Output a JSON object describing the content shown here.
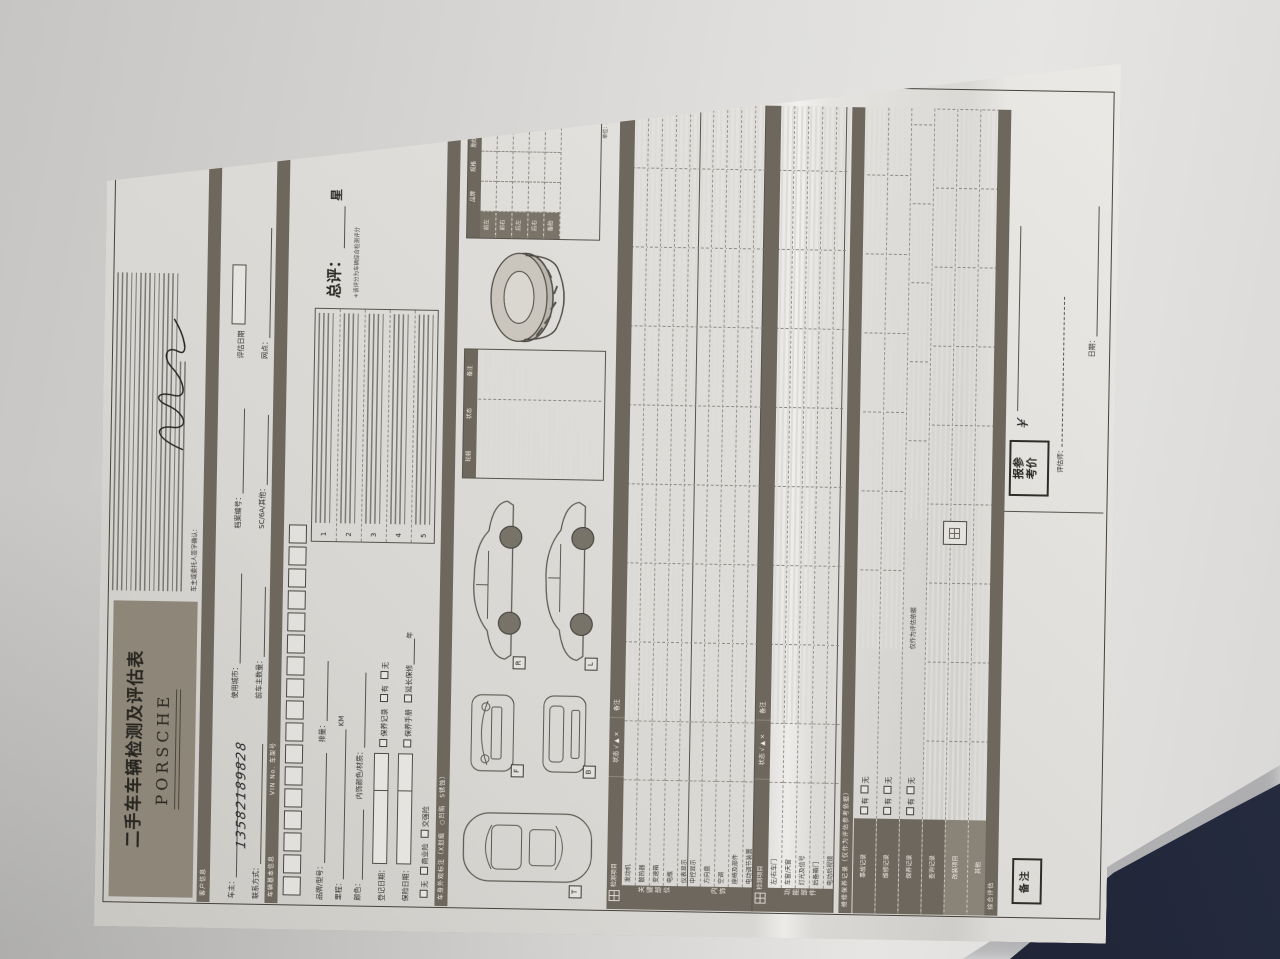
{
  "scene": {
    "table_color": "#dfdedc",
    "object_color": "#1d2233"
  },
  "header": {
    "title": "二手车车辆检测及评估表",
    "brand": "PORSCHE"
  },
  "client": {
    "section": "客户信息",
    "owner_label": "车主：",
    "city_label": "使用城市：",
    "file_label": "档案编号：",
    "eval_date_label": "评估日期",
    "phone_label": "联系方式：",
    "phone_value": "13582189828",
    "prev_owner_label": "前车主数量：",
    "type_label": "SC/6A/其他：",
    "outlet_label": "网点：",
    "sign_confirm": "车主或委托人签字确认："
  },
  "vehicle": {
    "section": "车辆基本信息",
    "vin_label": "VIN No. 车架号",
    "brand_model": "品牌/型号：",
    "displacement": "排量：",
    "mileage": "里程：",
    "km": "KM",
    "color": "颜色：",
    "interior": "内饰颜色/材质：",
    "reg_date": "登记日期：",
    "ins_date": "保险日期：",
    "maint_record": "保养记录",
    "manual": "保养手册",
    "ext_warranty": "延长保修",
    "year": "年",
    "yes": "有",
    "no": "无",
    "ins_none": "无",
    "ins_commercial": "商业险",
    "ins_compulsory": "交强险"
  },
  "rating": {
    "label": "总评：",
    "unit": "星",
    "note": "＊该评分为车辆综合检测评分",
    "rows": [
      "1",
      "2",
      "3",
      "4",
      "5"
    ]
  },
  "tire": {
    "unit_note": "单位：MM",
    "cols": [
      "品牌",
      "规格",
      "胎纹深度",
      "生产日期"
    ],
    "rows": [
      "前左",
      "前右",
      "后左",
      "后右",
      "备胎"
    ],
    "wheel_title": "轮毂",
    "wheel_cols": [
      "状态",
      "备注"
    ]
  },
  "body_strip": "车身外观标注（X划痕　○凹陷　S锈蚀）",
  "views": {
    "right": "R",
    "left": "L",
    "front": "F",
    "back": "B",
    "top": "T"
  },
  "checks": {
    "cols": {
      "item": "检测项目",
      "status": "状态",
      "legend": "√ ▲ ×",
      "remark": "备注"
    },
    "groups": [
      {
        "title": "关键部位",
        "items": [
          "发动机",
          "散热器",
          "变速箱",
          "电瓶",
          "仪表显示"
        ]
      },
      {
        "title": "内饰",
        "items": [
          "中控显示",
          "方向盘",
          "空调",
          "座椅及部件",
          "电动调节装置"
        ]
      },
      {
        "title": "功能部件",
        "items": [
          "左/右车门",
          "车窗/天窗",
          "灯光及信号",
          "后备箱门",
          "电动后视镜"
        ]
      }
    ]
  },
  "records": {
    "strip": "维修保养记录（仅作为评估参考依据）",
    "rows": [
      "事故记录",
      "维修记录",
      "保养记录",
      "查询记录",
      "改装项目",
      "其他"
    ],
    "yes": "有",
    "no": "无",
    "note": "仅作为评估依据"
  },
  "summary": {
    "strip": "综合评估",
    "remark_box": "备注",
    "price_box_1": "报参",
    "price_box_2": "考价",
    "currency": "¥",
    "appraiser_label": "评估师：",
    "date_label": "日期："
  }
}
